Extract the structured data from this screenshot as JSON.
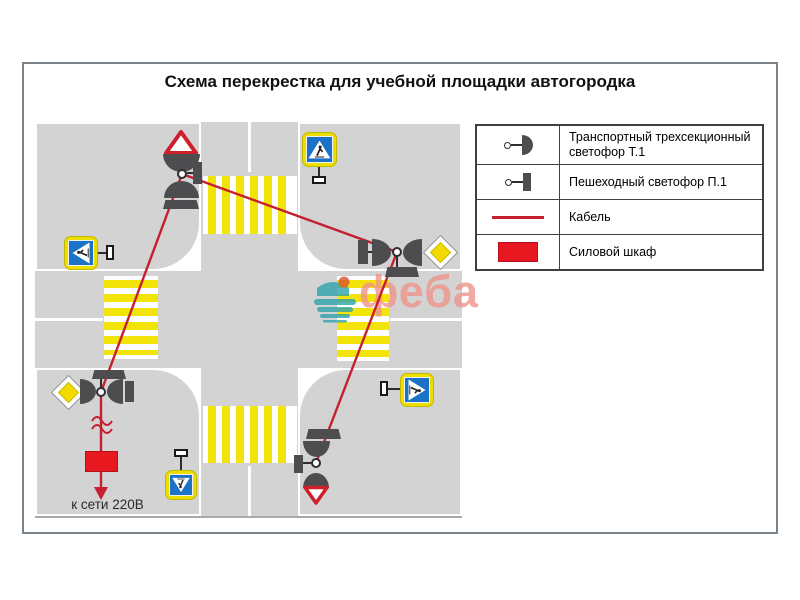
{
  "title": "Схема перекрестка для учебной площадки автогородка",
  "legend": {
    "items": [
      {
        "icon": "traffic-light-t1-icon",
        "label": "Транспортный трехсекционный светофор Т.1"
      },
      {
        "icon": "pedestrian-light-p1-icon",
        "label": "Пешеходный светофор П.1"
      },
      {
        "icon": "cable-icon",
        "label": "Кабель"
      },
      {
        "icon": "power-cabinet-icon",
        "label": "Силовой шкаф"
      }
    ]
  },
  "diagram": {
    "power_connection_label": "к сети 220В",
    "traffic_light_poles": 4,
    "crosswalks": 4,
    "signs": [
      "yield-sign-up",
      "pedestrian-crossing-sign-left",
      "pedestrian-crossing-sign-up",
      "priority-road-sign-right",
      "pedestrian-crossing-sign-right",
      "priority-road-sign-left",
      "pedestrian-crossing-sign-down",
      "yield-sign-down"
    ]
  },
  "watermark": {
    "text": "феба"
  },
  "colors": {
    "road_gray": "#d3d3d4",
    "stripe_yellow": "#f2e30a",
    "cable_red": "#c51f30",
    "cabinet_red": "#e7181f",
    "sign_blue": "#1c72c7",
    "sign_yellow_border": "#ecdf00",
    "priority_yellow": "#f1da00",
    "dark_fixture": "#4d4d4f"
  }
}
